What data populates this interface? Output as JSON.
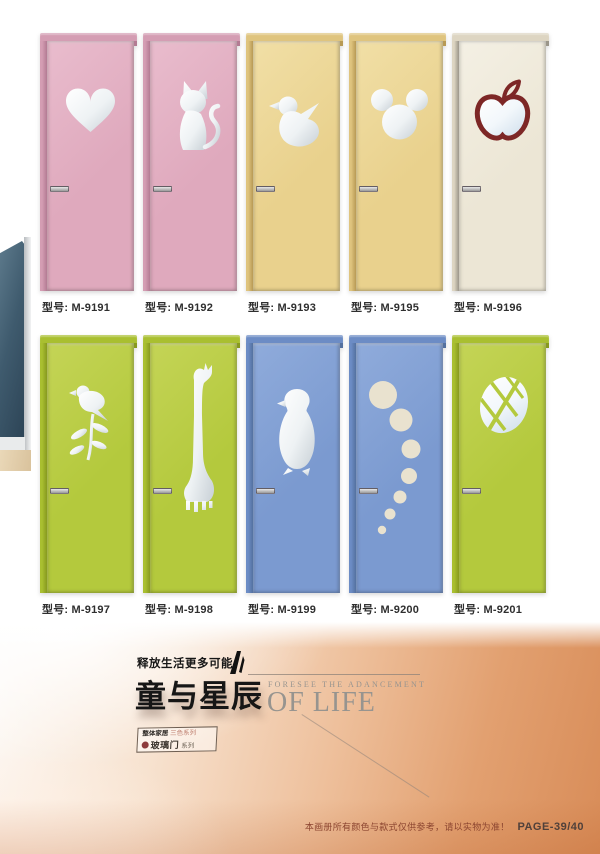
{
  "catalog": {
    "label_prefix": "型号:"
  },
  "doors": [
    {
      "model": "M-9191",
      "shape": "heart",
      "colors": {
        "slab": "#dfa9bd",
        "slabLight": "#e9bccd",
        "frame": "#d49db3",
        "edge": "#b37b93"
      }
    },
    {
      "model": "M-9192",
      "shape": "cat",
      "colors": {
        "slab": "#dfa9bd",
        "slabLight": "#e9bccd",
        "frame": "#d49db3",
        "edge": "#b37b93"
      }
    },
    {
      "model": "M-9193",
      "shape": "duck",
      "colors": {
        "slab": "#e9d18d",
        "slabLight": "#f1dfa6",
        "frame": "#dfc47e",
        "edge": "#b89a55"
      }
    },
    {
      "model": "M-9195",
      "shape": "mickey",
      "colors": {
        "slab": "#e9d18d",
        "slabLight": "#f1dfa6",
        "frame": "#dfc47e",
        "edge": "#b89a55"
      }
    },
    {
      "model": "M-9196",
      "shape": "apple",
      "colors": {
        "slab": "#ece6d5",
        "slabLight": "#f4f0e4",
        "frame": "#ddd5c2",
        "edge": "#9b968a",
        "accent": "#7d2726"
      }
    },
    {
      "model": "M-9197",
      "shape": "bird",
      "colors": {
        "slab": "#b4c93d",
        "slabLight": "#c4d456",
        "frame": "#a9bf30",
        "edge": "#87991f"
      }
    },
    {
      "model": "M-9198",
      "shape": "giraffe",
      "colors": {
        "slab": "#b4c93d",
        "slabLight": "#c4d456",
        "frame": "#a9bf30",
        "edge": "#87991f"
      }
    },
    {
      "model": "M-9199",
      "shape": "penguin",
      "colors": {
        "slab": "#7b9ad0",
        "slabLight": "#8fabdb",
        "frame": "#6c8cc5",
        "edge": "#54719f"
      }
    },
    {
      "model": "M-9200",
      "shape": "bubbles",
      "colors": {
        "slab": "#7b9ad0",
        "slabLight": "#8fabdb",
        "frame": "#6c8cc5",
        "edge": "#54719f",
        "cutout": "#e9e2cf"
      }
    },
    {
      "model": "M-9201",
      "shape": "leaf",
      "colors": {
        "slab": "#b4c93d",
        "slabLight": "#c4d456",
        "frame": "#a9bf30",
        "edge": "#87991f"
      }
    }
  ],
  "banner": {
    "tagline": "释放生活更多可能",
    "title": "童与星辰",
    "subtitle_small": "FORESEE THE ADANCEMENT",
    "subtitle_large": "OF LIFE",
    "badge": {
      "line1_strong": "整体家居",
      "line1_light": "三色系列",
      "line2_strong": "玻璃门",
      "line2_small": "系列"
    }
  },
  "footer": {
    "disclaimer": "本画册所有颜色与款式仅供参考，请以实物为准！",
    "page_number": "PAGE-39/40"
  },
  "theme": {
    "label_color": "#2f2f2f",
    "title_color": "#161616",
    "sub_color": "#97948f",
    "line_color": "#8f837a",
    "disclaimer_color": "#8c4530",
    "pagenum_color": "#50403a",
    "banner_1": "#fdfaf7",
    "banner_2": "#f7e2cf",
    "banner_3": "#eec09c",
    "banner_4": "#e2a070",
    "banner_5": "#d88c58",
    "photo_door": "#3f5b6e",
    "photo_door_light": "#5d7a8c",
    "photo_door_dark": "#2c4355",
    "photo_floor": "#d9c29c",
    "photo_floor_light": "#ead8b8"
  }
}
